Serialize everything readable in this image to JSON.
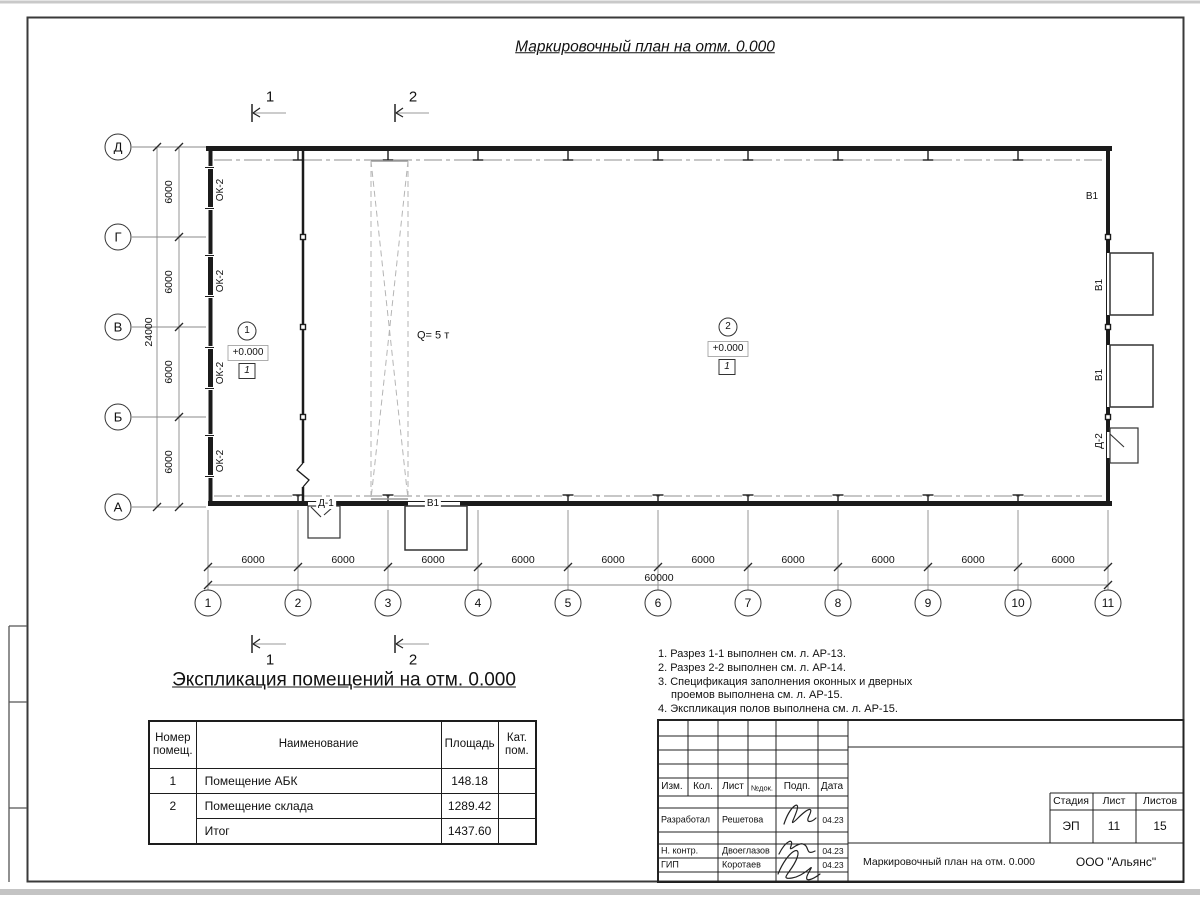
{
  "sheet_title": "Маркировочный план на отм. 0.000",
  "plan": {
    "section1": "1",
    "section2": "2",
    "row_axes": [
      "Д",
      "Г",
      "В",
      "Б",
      "А"
    ],
    "col_axes": [
      "1",
      "2",
      "3",
      "4",
      "5",
      "6",
      "7",
      "8",
      "9",
      "10",
      "11"
    ],
    "row_dims": [
      "6000",
      "6000",
      "6000",
      "6000"
    ],
    "row_total": "24000",
    "col_dims": [
      "6000",
      "6000",
      "6000",
      "6000",
      "6000",
      "6000",
      "6000",
      "6000",
      "6000",
      "6000"
    ],
    "col_total": "60000",
    "windows": [
      "ОК-2",
      "ОК-2",
      "ОК-2",
      "ОК-2"
    ],
    "crane_capacity": "Q= 5 т",
    "door1": "Д-1",
    "door2": "Д-2",
    "gate_bottom": "В1",
    "gate_right_top": "В1",
    "gates_right": [
      "В1",
      "В1"
    ],
    "room1": {
      "num": "1",
      "elev": "+0.000",
      "floor": "1"
    },
    "room2": {
      "num": "2",
      "elev": "+0.000",
      "floor": "1"
    }
  },
  "expl": {
    "title": "Экспликация помещений на отм. 0.000",
    "col_num": "Номер помещ.",
    "col_name": "Наименование",
    "col_area": "Площадь",
    "col_cat": "Кат. пом.",
    "rows": [
      {
        "num": "1",
        "name": "Помещение АБК",
        "area": "148.18",
        "cat": ""
      },
      {
        "num": "2",
        "name": "Помещение склада",
        "area": "1289.42",
        "cat": ""
      },
      {
        "num": "",
        "name": "Итог",
        "area": "1437.60",
        "cat": ""
      }
    ]
  },
  "notes": {
    "n1": "1. Разрез 1-1 выполнен см. л. АР-13.",
    "n2": "2. Разрез 2-2 выполнен см. л. АР-14.",
    "n3a": "3. Спецификация заполнения оконных и дверных",
    "n3b": "проемов выполнена см. л. АР-15.",
    "n4": "4. Экспликация полов выполнена см. л. АР-15."
  },
  "stamp": {
    "h_izm": "Изм.",
    "h_kol": "Кол.",
    "h_list": "Лист",
    "h_ndok": "№док.",
    "h_podp": "Подп.",
    "h_data": "Дата",
    "r1_role": "Разработал",
    "r1_name": "Решетова",
    "r1_date": "04.23",
    "r2_role": "Н. контр.",
    "r2_name": "Двоеглазов",
    "r2_date": "04.23",
    "r3_role": "ГИП",
    "r3_name": "Коротаев",
    "r3_date": "04.23",
    "stage_h": "Стадия",
    "list_h": "Лист",
    "listov_h": "Листов",
    "stage_v": "ЭП",
    "list_v": "11",
    "listov_v": "15",
    "doc_title": "Маркировочный план на отм. 0.000",
    "company": "ООО \"Альянс\""
  }
}
